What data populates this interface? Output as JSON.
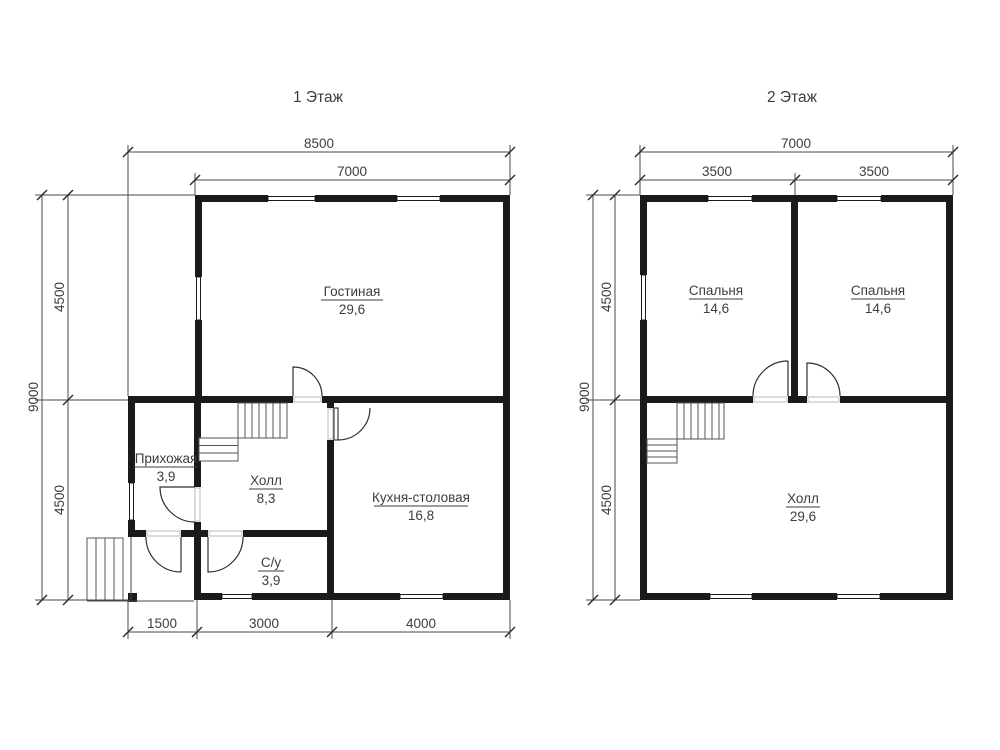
{
  "floor1": {
    "title": "1 Этаж",
    "dims": {
      "width_total": "8500",
      "width_main": "7000",
      "bottom_left": "1500",
      "bottom_mid": "3000",
      "bottom_right": "4000",
      "height_total": "9000",
      "height_top": "4500",
      "height_bottom": "4500"
    },
    "rooms": {
      "living": {
        "name": "Гостиная",
        "area": "29,6"
      },
      "hallway": {
        "name": "Прихожая",
        "area": "3,9"
      },
      "hall": {
        "name": "Холл",
        "area": "8,3"
      },
      "bathroom": {
        "name": "С/у",
        "area": "3,9"
      },
      "kitchen": {
        "name": "Кухня-столовая",
        "area": "16,8"
      }
    }
  },
  "floor2": {
    "title": "2 Этаж",
    "dims": {
      "width_total": "7000",
      "width_left": "3500",
      "width_right": "3500",
      "height_total": "9000",
      "height_top": "4500",
      "height_bottom": "4500"
    },
    "rooms": {
      "bedroom1": {
        "name": "Спальня",
        "area": "14,6"
      },
      "bedroom2": {
        "name": "Спальня",
        "area": "14,6"
      },
      "hall": {
        "name": "Холл",
        "area": "29,6"
      }
    }
  },
  "colors": {
    "wall": "#1a1a1a",
    "dimension_line": "#4a4a4a",
    "text": "#3d3d3d",
    "background": "#ffffff"
  }
}
